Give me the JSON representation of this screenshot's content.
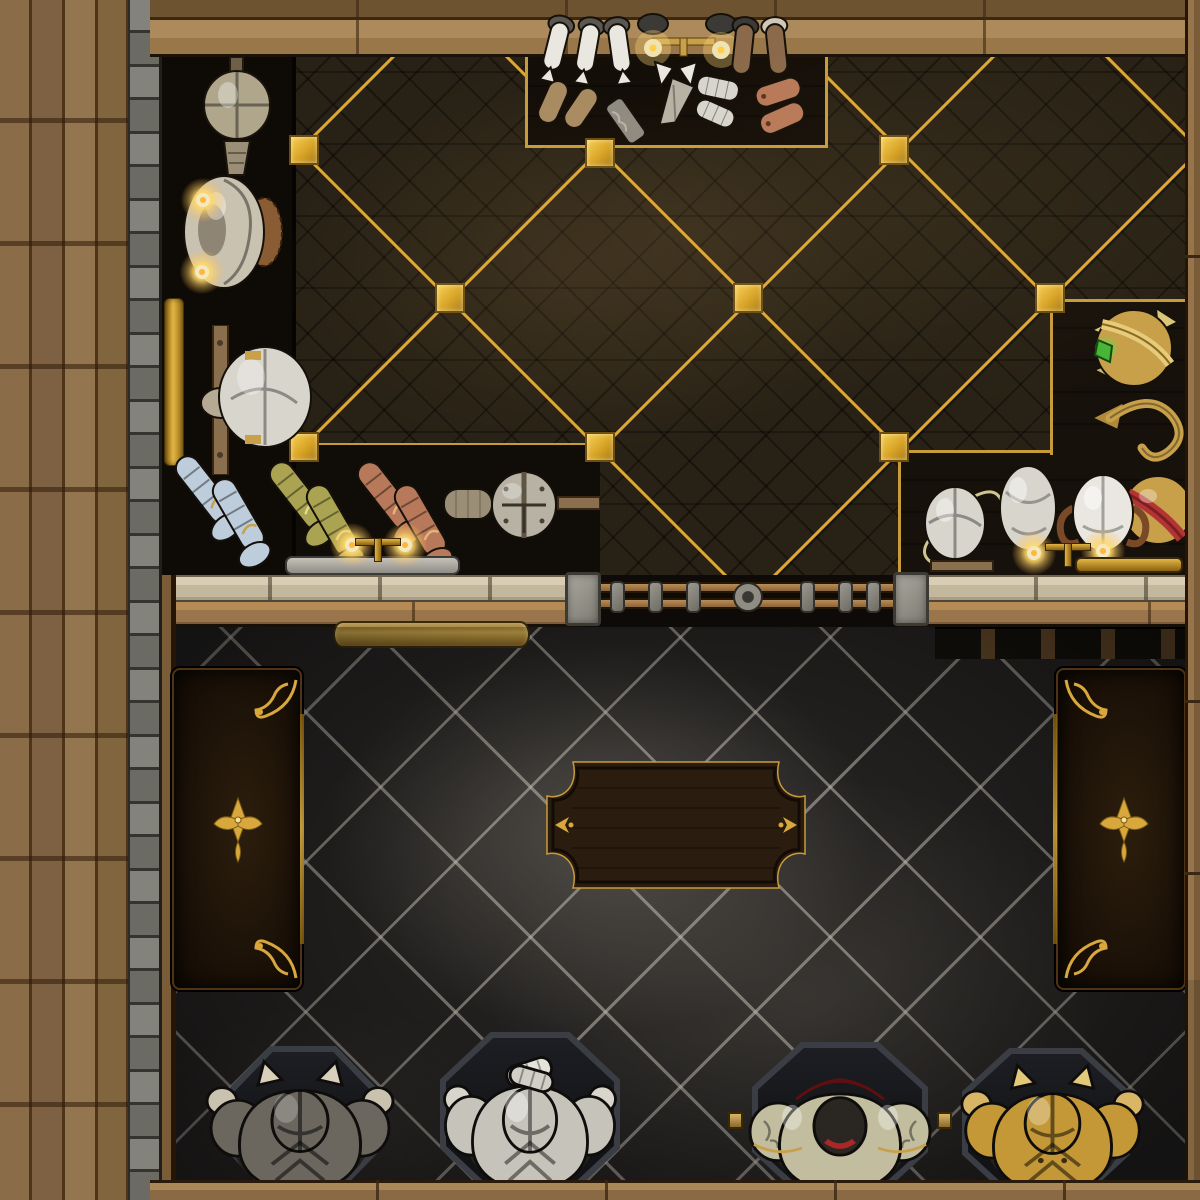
{
  "scene": {
    "type": "top-down fantasy battlemap",
    "setting": "armory shop interior",
    "rooms": {
      "workshop": "dark parquet floor with gold inlay diamond grid, wall racks and display case of armor pieces",
      "showroom": "black marble tiled floor with central wooden table, display cabinets and four armor stands"
    }
  },
  "palette": {
    "gold_inlay": "#dfa733",
    "gold_bright": "#f1c545",
    "ornament_gold": "#d8a83c",
    "parquet": "#282115",
    "plank_wood": "#8a6c49",
    "band_wood": "#a5835a",
    "stone": "#7e7d76",
    "counter_stone": "#cbbfa7",
    "counter_wood": "#a37c4c",
    "marble": "#232120",
    "grout": "#9b988f",
    "cabinet_wood": "#1d1409",
    "table_wood": "#2a1c0e",
    "steel": "#b7b2a4",
    "silver": "#d8d5cd",
    "white_metal": "#e9e7e0",
    "brass": "#c8a04a",
    "copper": "#b8795a",
    "leather": "#a98b62",
    "brown_leather": "#8a6a4a",
    "blue_steel": "#becddb",
    "olive_gold": "#aaa452",
    "gem_green": "#46b536",
    "plume_red": "#b23434",
    "candle_glow": "#ffd98a"
  },
  "items": {
    "wall_rack": [
      "steel helm on wall stand",
      "armor bust with lit candles",
      "gold wall trim",
      "silver helm on wooden rack"
    ],
    "display_case": [
      "silver sabatons pair",
      "steel boot cuffs",
      "candle pair with gold stand",
      "white gauntlets",
      "leather boots pair",
      "leather gloves",
      "engraved steel bracer",
      "steel kite bracer",
      "segmented silver bracers",
      "copper bracers"
    ],
    "boot_row": [
      "blue ornate sabatons",
      "green ornate sabatons",
      "copper ornate sabatons",
      "gladiator helm on mount",
      "silver candle tray"
    ],
    "right_display": [
      "gold helm with green gem",
      "gold grappling hook",
      "gold helm with red plume"
    ],
    "helmet_row": [
      "silver helm with plume",
      "silver helm",
      "white helm with brown plumes",
      "candle pair with gold stand"
    ],
    "showroom": [
      "left display cabinet",
      "right display cabinet",
      "ornate wooden table",
      "brass wall shelf",
      "gold tray"
    ],
    "armor_stands": [
      {
        "name": "dark steel armor with horns",
        "color": "#6b675f"
      },
      {
        "name": "polished silver armor with clasped gauntlets",
        "color": "#c6c3bb"
      },
      {
        "name": "enameled armor with red plume",
        "color": "#c2bd9e"
      },
      {
        "name": "gilded armor with horns",
        "color": "#c49836"
      }
    ]
  }
}
